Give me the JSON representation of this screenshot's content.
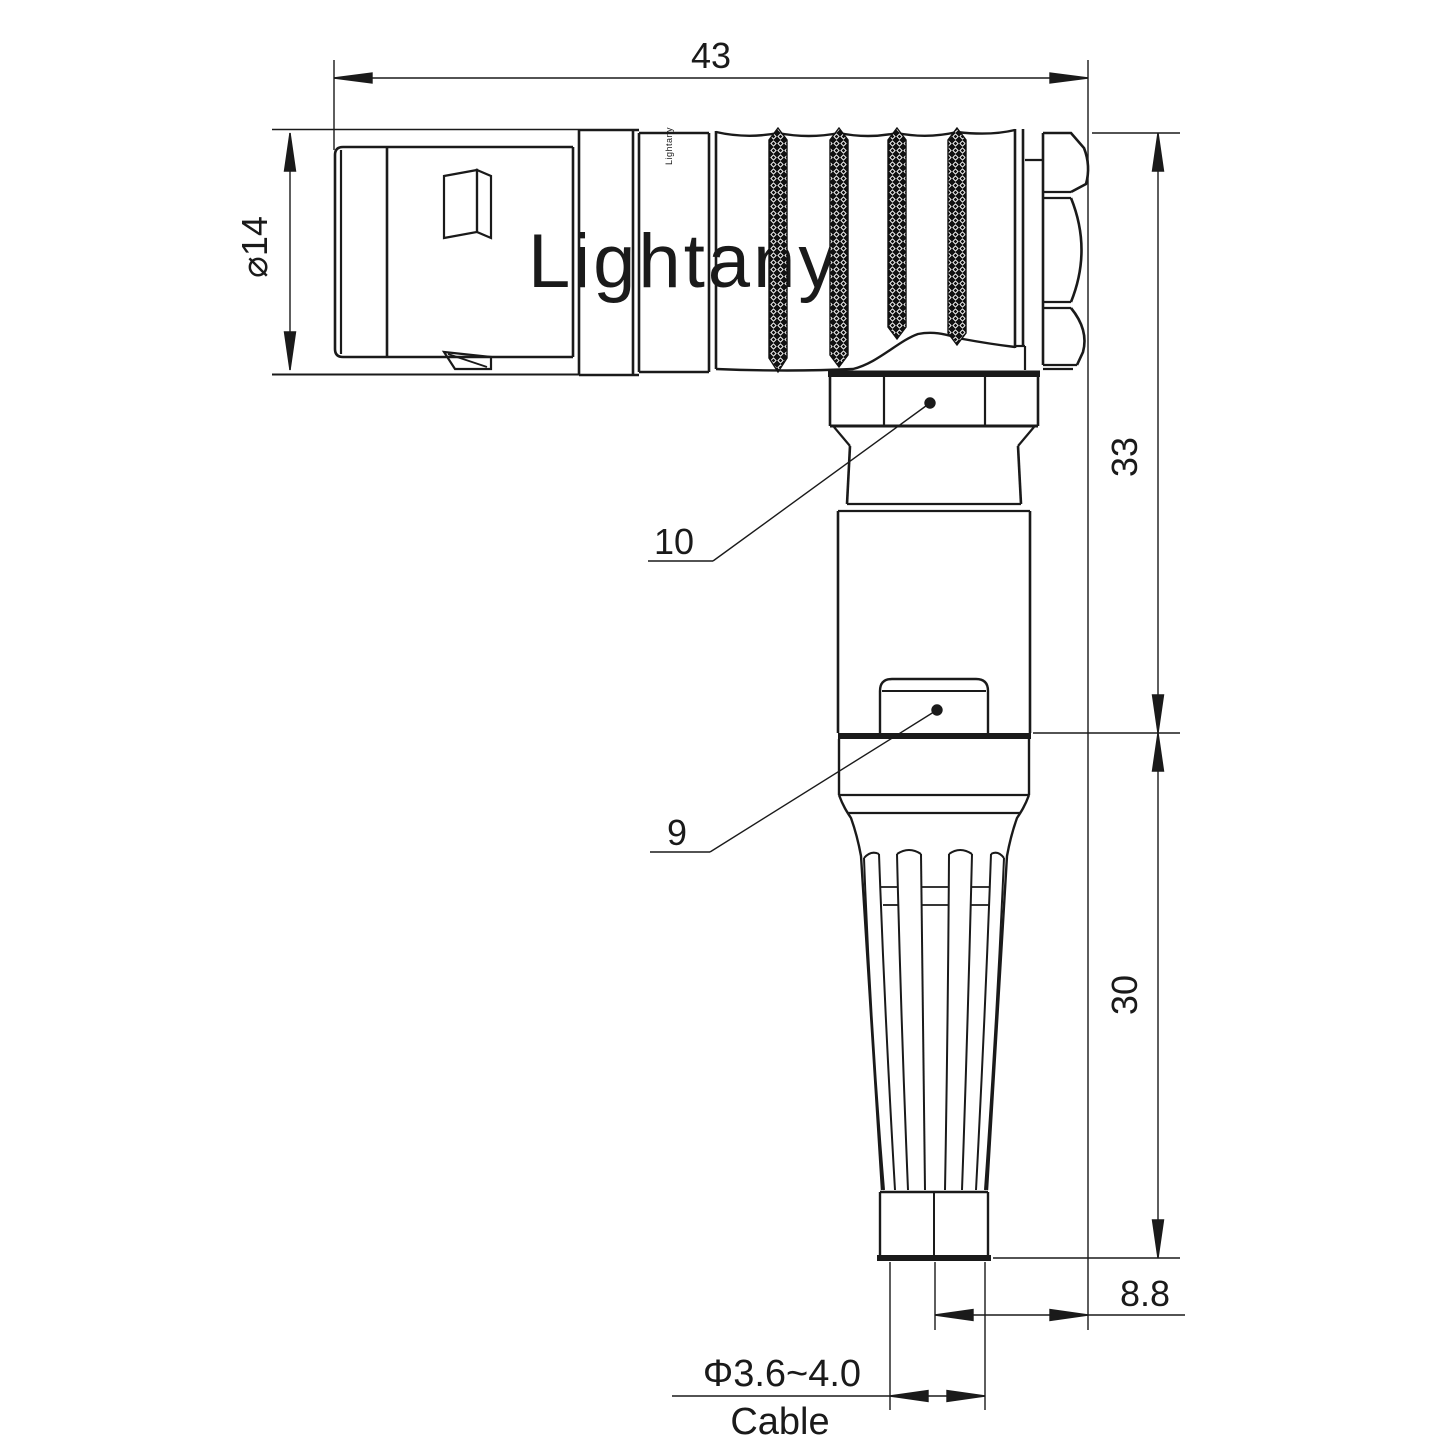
{
  "drawing": {
    "watermark": "Lightany",
    "brand_mark": "Lightany",
    "colors": {
      "line": "#1a1a1a",
      "watermark_pink": "#f5c6c6"
    },
    "dimensions": {
      "overall_length": "43",
      "shell_diameter": "⌀14",
      "upper_height": "33",
      "lower_height": "30",
      "cable_offset": "8.8",
      "cable_diameter": "Φ3.6~4.0",
      "cable_label": "Cable"
    },
    "part_labels": {
      "coupling_nut": "10",
      "release_sleeve": "9"
    }
  }
}
